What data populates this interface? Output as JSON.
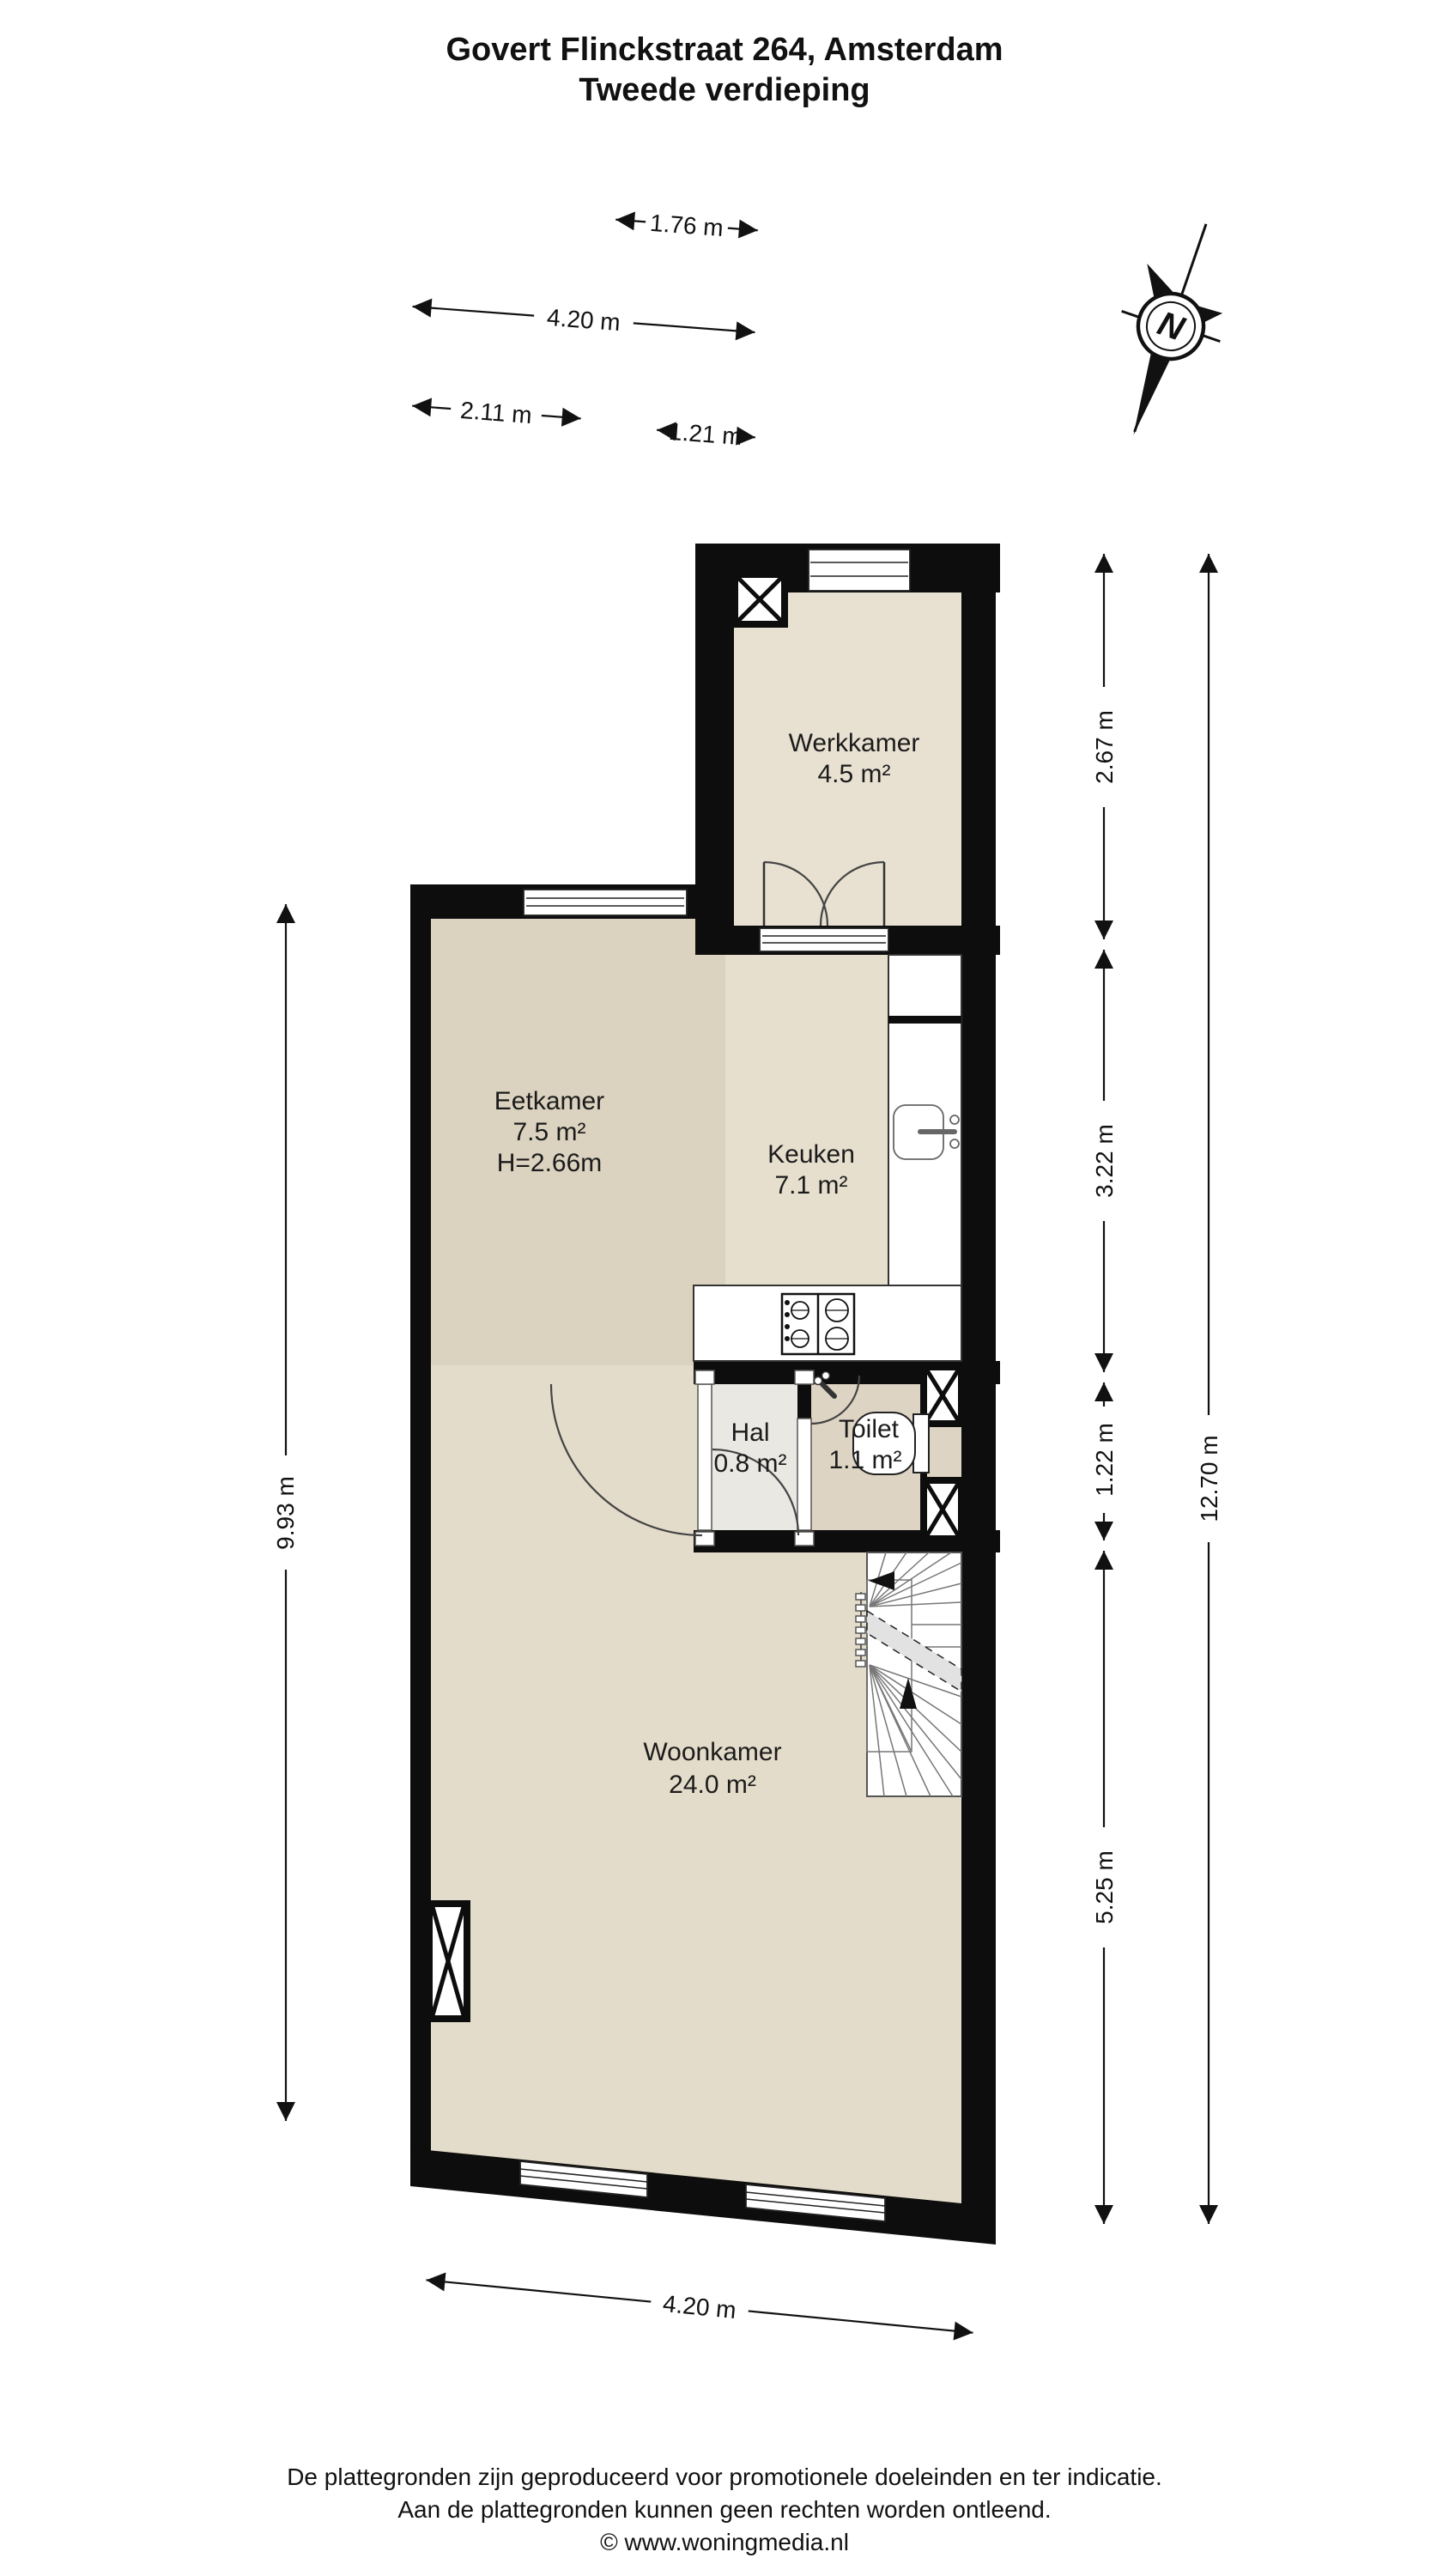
{
  "title": {
    "line1": "Govert Flinckstraat 264, Amsterdam",
    "line2": "Tweede verdieping"
  },
  "compass": {
    "label": "N"
  },
  "rooms": {
    "werkkamer": {
      "name": "Werkkamer",
      "area": "4.5 m²"
    },
    "eetkamer": {
      "name": "Eetkamer",
      "area": "7.5 m²",
      "ceiling": "H=2.66m"
    },
    "keuken": {
      "name": "Keuken",
      "area": "7.1 m²"
    },
    "hal": {
      "name": "Hal",
      "area": "0.8 m²"
    },
    "toilet": {
      "name": "Toilet",
      "area": "1.1 m²"
    },
    "woonkamer": {
      "name": "Woonkamer",
      "area": "24.0 m²"
    }
  },
  "dimensions": {
    "top_width_werkkamer": "1.76 m",
    "top_width_total": "4.20 m",
    "top_width_eetkamer": "2.11 m",
    "top_width_keuken": "1.21 m",
    "left_height": "9.93 m",
    "right_werkkamer": "2.67 m",
    "right_keuken": "3.22 m",
    "right_hal": "1.22 m",
    "right_woonkamer": "5.25 m",
    "right_total": "12.70 m",
    "bottom_width": "4.20 m"
  },
  "footer": {
    "line1": "De plattegronden zijn geproduceerd voor promotionele doeleinden en ter indicatie.",
    "line2": "Aan de plattegronden kunnen geen rechten worden ontleend.",
    "line3": "© www.woningmedia.nl"
  },
  "colors": {
    "wall": "#0d0d0d",
    "floor_woonkamer": "#e4dcca",
    "floor_eetkamer": "#dbd2c0",
    "floor_keuken": "#e6dfce",
    "floor_werkkamer": "#e8e1d2",
    "floor_toilet": "#ded4c4",
    "floor_hal": "#eae8e3"
  }
}
